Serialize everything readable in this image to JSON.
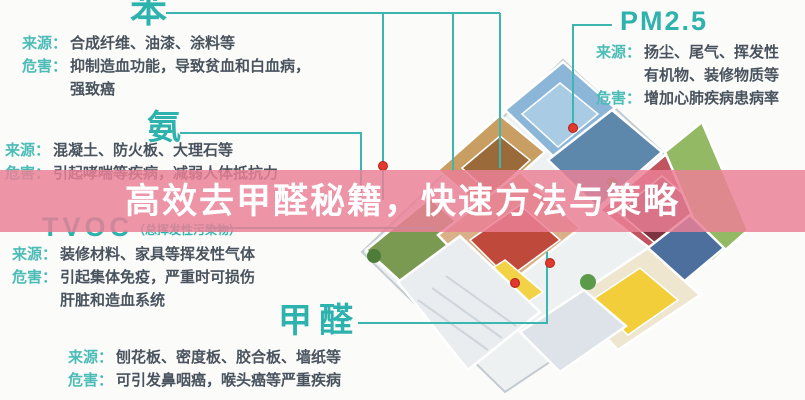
{
  "banner": {
    "title": "高效去甲醛秘籍，快速方法与策略",
    "color": "#eb8096"
  },
  "palette": {
    "accent_teal": "#2eb2ae",
    "label_teal": "#4cbcb6",
    "body_text": "#49535e",
    "marker_red": "#e0392e",
    "connector_teal": "#3db6b2"
  },
  "pollutants": {
    "benzene": {
      "name": "苯",
      "source_label": "来源：",
      "source": "合成纤维、油漆、涂料等",
      "harm_label": "危害：",
      "harm_line1": "抑制造血功能，导致贫血和白血病，",
      "harm_line2": "强致癌"
    },
    "ammonia": {
      "name": "氨",
      "source_label": "来源：",
      "source": "混凝土、防火板、大理石等",
      "harm_label": "危害：",
      "harm_line1": "引起哮喘等疾病，减弱人体抵抗力"
    },
    "tvoc": {
      "name": "TVOC",
      "note": "（总挥发性污染物）",
      "source_label": "来源：",
      "source": "装修材料、家具等挥发性气体",
      "harm_label": "危害：",
      "harm_line1": "引起集体免疫，严重时可损伤",
      "harm_line2": "肝脏和造血系统"
    },
    "formaldehyde": {
      "name": "甲醛",
      "source_label": "来源：",
      "source": "刨花板、密度板、胶合板、墙纸等",
      "harm_label": "危害：",
      "harm_line1": "可引发鼻咽癌，喉头癌等严重疾病"
    },
    "pm25": {
      "name": "PM2.5",
      "source_label": "来源：",
      "source_line1": "扬尘、尾气、挥发性",
      "source_line2": "有机物、装修物质等",
      "harm_label": "危害：",
      "harm_line1": "增加心肺疾病患病率"
    }
  }
}
